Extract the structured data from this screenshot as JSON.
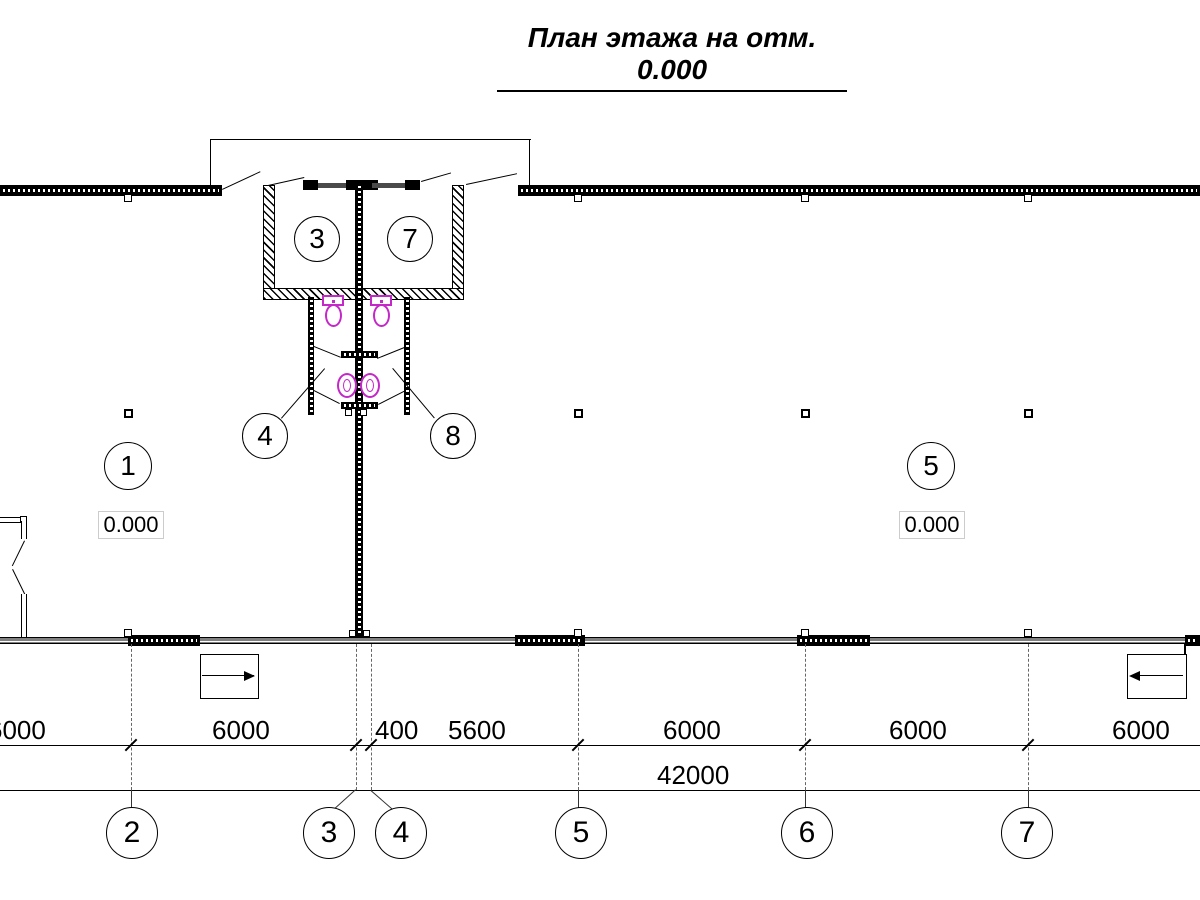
{
  "title": "План этажа на отм. 0.000",
  "rooms": {
    "r1": "1",
    "r3": "3",
    "r4": "4",
    "r5": "5",
    "r7": "7",
    "r8": "8"
  },
  "elevations": {
    "left": "0.000",
    "right": "0.000"
  },
  "dims": {
    "segments": [
      "6000",
      "6000",
      "400",
      "5600",
      "6000",
      "6000",
      "6000"
    ],
    "total": "42000"
  },
  "grid": {
    "axes": [
      "2",
      "3",
      "4",
      "5",
      "6",
      "7"
    ]
  },
  "colors": {
    "line": "#000000",
    "fixture_magenta": "#c428c8",
    "ext_line_gray": "#666666",
    "window_band": "#4a4a4a",
    "elev_box_border": "#cccccc"
  }
}
